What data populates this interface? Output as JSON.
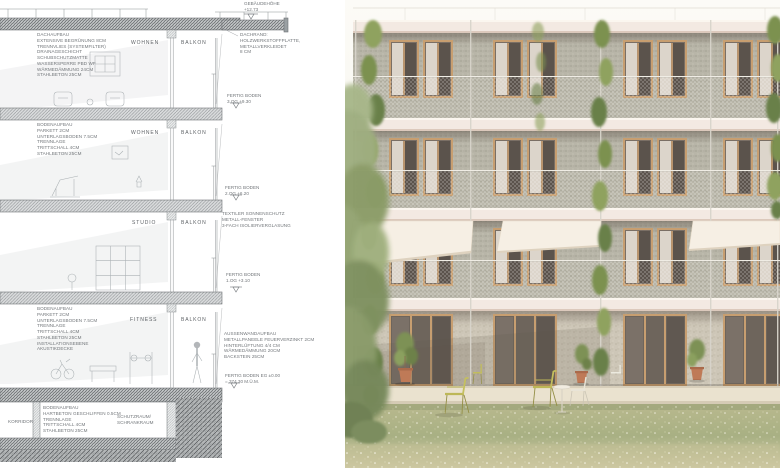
{
  "palette": {
    "paper": "#ffffff",
    "line": "#8d9194",
    "slab": "#f3e9e2",
    "panel": "#b8b5a8",
    "wood": "#c79e70",
    "glass": "#5b534c",
    "curtain": "#e4ddd4",
    "awning": "#f6efe4",
    "stone": "#cdc6b7",
    "terrace": "#eae2cf",
    "meadow_a": "#cfc9a4",
    "meadow_b": "#95a072",
    "vine": "#7e9150",
    "tree": "#9cab7c",
    "terracotta": "#bf7a57",
    "chair": "#c2bd5c"
  },
  "section": {
    "building_height": {
      "label": "GEBÄUDEHÖHE",
      "value": "+12.73"
    },
    "roof_callout": [
      "DACHAUFBAU",
      "EXTENSIVE BEGRÜNUNG 8CM",
      "TRENNVLIES (SYSTEMFILTER)",
      "DRAINAGESCHICHT",
      "SCHUBSCHUTZMATTE",
      "WASSERSPERRE PBD WF",
      "WÄRMEDÄMMUNG 24CM",
      "STAHLBETON 25CM"
    ],
    "roof_edge_callout": [
      "DACHRAND:",
      "HOLZWERKSTOFFPLATTE,",
      "METALLVERKLEIDET",
      "8 CM"
    ],
    "floor_markers": {
      "og3": [
        "FERTIG BODEN",
        "3.OG +9.30"
      ],
      "og2": [
        "FERTIG BODEN",
        "2.OG +6.20"
      ],
      "og1": [
        "FERTIG BODEN",
        "1.OG +3.10"
      ],
      "eg": [
        "FERTIG BODEN EG ±0.00",
        "= 374.30 M.Ü.M."
      ]
    },
    "floor_callout_upper": [
      "BODENAUFBAU",
      "PARKETT 2CM",
      "UNTERLAGSBODEN 7.5CM",
      "TRENNLAGE",
      "TRITTSCHALL 4CM",
      "STAHLBETON 25CM"
    ],
    "sunshade_callout": [
      "TEXTILER SONNENSCHUTZ",
      "METALL-FENSTER",
      "3-FACH ISOLIERVERGLASUNG"
    ],
    "floor_callout_fitness": [
      "BODENAUFBAU",
      "PARKETT 2CM",
      "UNTERLAGSBODEN 7.5CM",
      "TRENNLAGE",
      "TRITTSCHALL 4CM",
      "STAHLBETON 25CM",
      "INSTALLATIONSEBENE",
      "AKUSTIKDECKE"
    ],
    "wall_callout": [
      "AUSSENWANDAUFBAU",
      "METALLPANEELE FEUERVERZINKT 2CM",
      "HINTERLÜFTUNG 4/4 CM",
      "WÄRMEDÄMMUNG 20CM",
      "BACKSTEIN 25CM"
    ],
    "ground_callout": [
      "BODENAUFBAU",
      "HARTBETON GESCHLIFFEN 0.5CM",
      "TRENNLAGE",
      "TRITTSCHALL 4CM",
      "STAHLBETON 25CM"
    ],
    "floors": [
      {
        "room": "WOHNEN",
        "balcony": "BALKON"
      },
      {
        "room": "WOHNEN",
        "balcony": "BALKON"
      },
      {
        "room": "STUDIO",
        "balcony": "BALKON"
      },
      {
        "room": "FITNESS",
        "balcony": "BALKON"
      }
    ],
    "basement": {
      "left": "KORRIDOR",
      "right": [
        "SCHUTZRAUM/",
        "SCHRANKRAUM"
      ]
    }
  }
}
